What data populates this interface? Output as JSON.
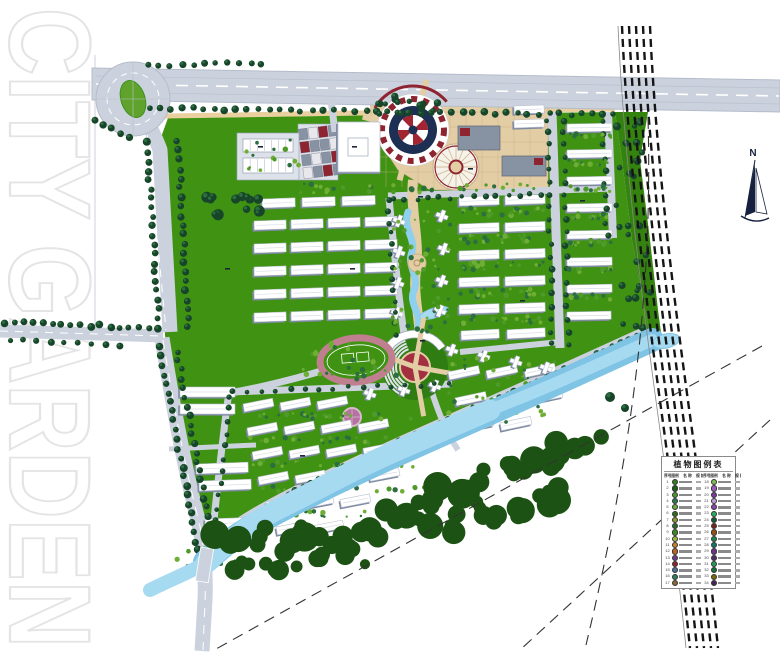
{
  "watermark": "CITY GARDEN",
  "north_label": "N",
  "legend": {
    "title": "植物图例表",
    "headers": [
      "序号",
      "图例",
      "名 称",
      "规 格",
      "序号",
      "图例",
      "名 称",
      "规 格"
    ],
    "rows": [
      {
        "ln": "1",
        "lc": "#357c1f",
        "rn": "18",
        "rc": "#7fbf4d"
      },
      {
        "ln": "2",
        "lc": "#1e5c13",
        "rn": "19",
        "rc": "#9b59b6"
      },
      {
        "ln": "3",
        "lc": "#4c9a2e",
        "rn": "20",
        "rc": "#7d3c98"
      },
      {
        "ln": "4",
        "lc": "#2c7a4f",
        "rn": "21",
        "rc": "#c39bd8"
      },
      {
        "ln": "5",
        "lc": "#6aae3a",
        "rn": "22",
        "rc": "#8e44ad"
      },
      {
        "ln": "6",
        "lc": "#2f6e1d",
        "rn": "23",
        "rc": "#27ae60"
      },
      {
        "ln": "7",
        "lc": "#8a9a2f",
        "rn": "24",
        "rc": "#145a32"
      },
      {
        "ln": "8",
        "lc": "#256e35",
        "rn": "25",
        "rc": "#7b241c"
      },
      {
        "ln": "9",
        "lc": "#3c8a1f",
        "rn": "26",
        "rc": "#935116"
      },
      {
        "ln": "10",
        "lc": "#9ab83c",
        "rn": "27",
        "rc": "#1e8449"
      },
      {
        "ln": "11",
        "lc": "#c97e2a",
        "rn": "28",
        "rc": "#117864"
      },
      {
        "ln": "12",
        "lc": "#b8641f",
        "rn": "29",
        "rc": "#6c3483"
      },
      {
        "ln": "13",
        "lc": "#6a3f8f",
        "rn": "30",
        "rc": "#512e5f"
      },
      {
        "ln": "14",
        "lc": "#8e2430",
        "rn": "31",
        "rc": "#239b56"
      },
      {
        "ln": "15",
        "lc": "#4a6f9a",
        "rn": "32",
        "rc": "#196f3d"
      },
      {
        "ln": "16",
        "lc": "#2f7d5e",
        "rn": "33",
        "rc": "#7d6608"
      },
      {
        "ln": "17",
        "lc": "#8a6a2f",
        "rn": "34",
        "rc": "#4a235a"
      }
    ]
  },
  "palette": {
    "road": "#ccd2dd",
    "road_line": "#b4bccb",
    "lane": "#b8c0cf",
    "green": "#3f9212",
    "green_dark": "#2f7d12",
    "buffer": "#35830f",
    "island": "#5fa32c",
    "tree": "#17452a",
    "tree_light": "#2c6e3f",
    "shrub": "#6fae35",
    "forest": "#1c5213",
    "river": "#a5daf1",
    "river_edge": "#7fc4e4",
    "stream": "#8fd0ee",
    "plaza": "#e3cda4",
    "plaza_line": "#c9ae84",
    "pale": "#dce1ea",
    "accent_red": "#8e2430",
    "pin_red": "#a32532",
    "slate": "#8792a2",
    "navy": "#1d2f52",
    "building": "#ffffff",
    "building_shadow": "#7e8aa0",
    "building_edge": "#b9c0cf",
    "track": "#c07f8e",
    "garden_pink": "#b5719f",
    "rail": "#151515",
    "dash": "#333333",
    "watermark_stroke": "#e4e4e4"
  }
}
